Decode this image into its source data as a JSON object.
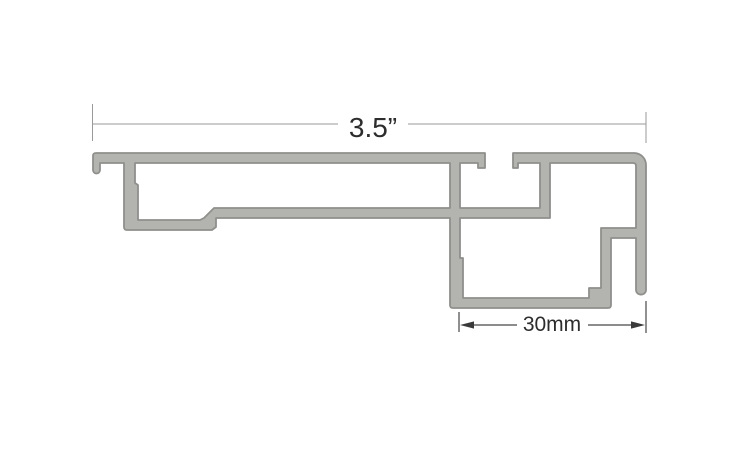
{
  "diagram": {
    "background": "#ffffff",
    "profile": {
      "fill_color": "#b3b3b0",
      "outline_color": "#8f8f8c",
      "path_d": "M93,156 Q93,153 96,153 L485,153 L485,168 L478,168 L478,163 L460,163 L460,208 L540,208 L540,163 L518,163 L518,168 L513,168 L513,153 L634,153 A12,12 0 0 1 646,165 L646,290 A5,4.6 0 0 1 636,290 L636,238 L611,238 L611,305 Q611,308 608,308 L453,308 Q450,308 450,305 L450,218 L216,218 L216,227 L212,230 L127,230 Q124,230 124,227 L124,163 L100,163 L100,170 A3.5,3.5 0 0 1 93,170 L93,156 Z M135,163 L450,163 L450,208 L214,208 L204,218 L200,220 L138,220 L138,185 L135,183 L135,163 Z M460,218 L550,218 L550,163 L633,163 Q636,163 636,166 L636,228 L601,228 L601,288 L589,288 L589,298 L463,298 L463,258 L460,258 L460,218 Z"
    },
    "dimension_width": {
      "label": "3.5”",
      "line_color": "#9a9a9a",
      "text_color": "#2d2d2d"
    },
    "dimension_depth": {
      "label": "30mm",
      "line_color": "#474747",
      "text_color": "#2d2d2d"
    }
  }
}
